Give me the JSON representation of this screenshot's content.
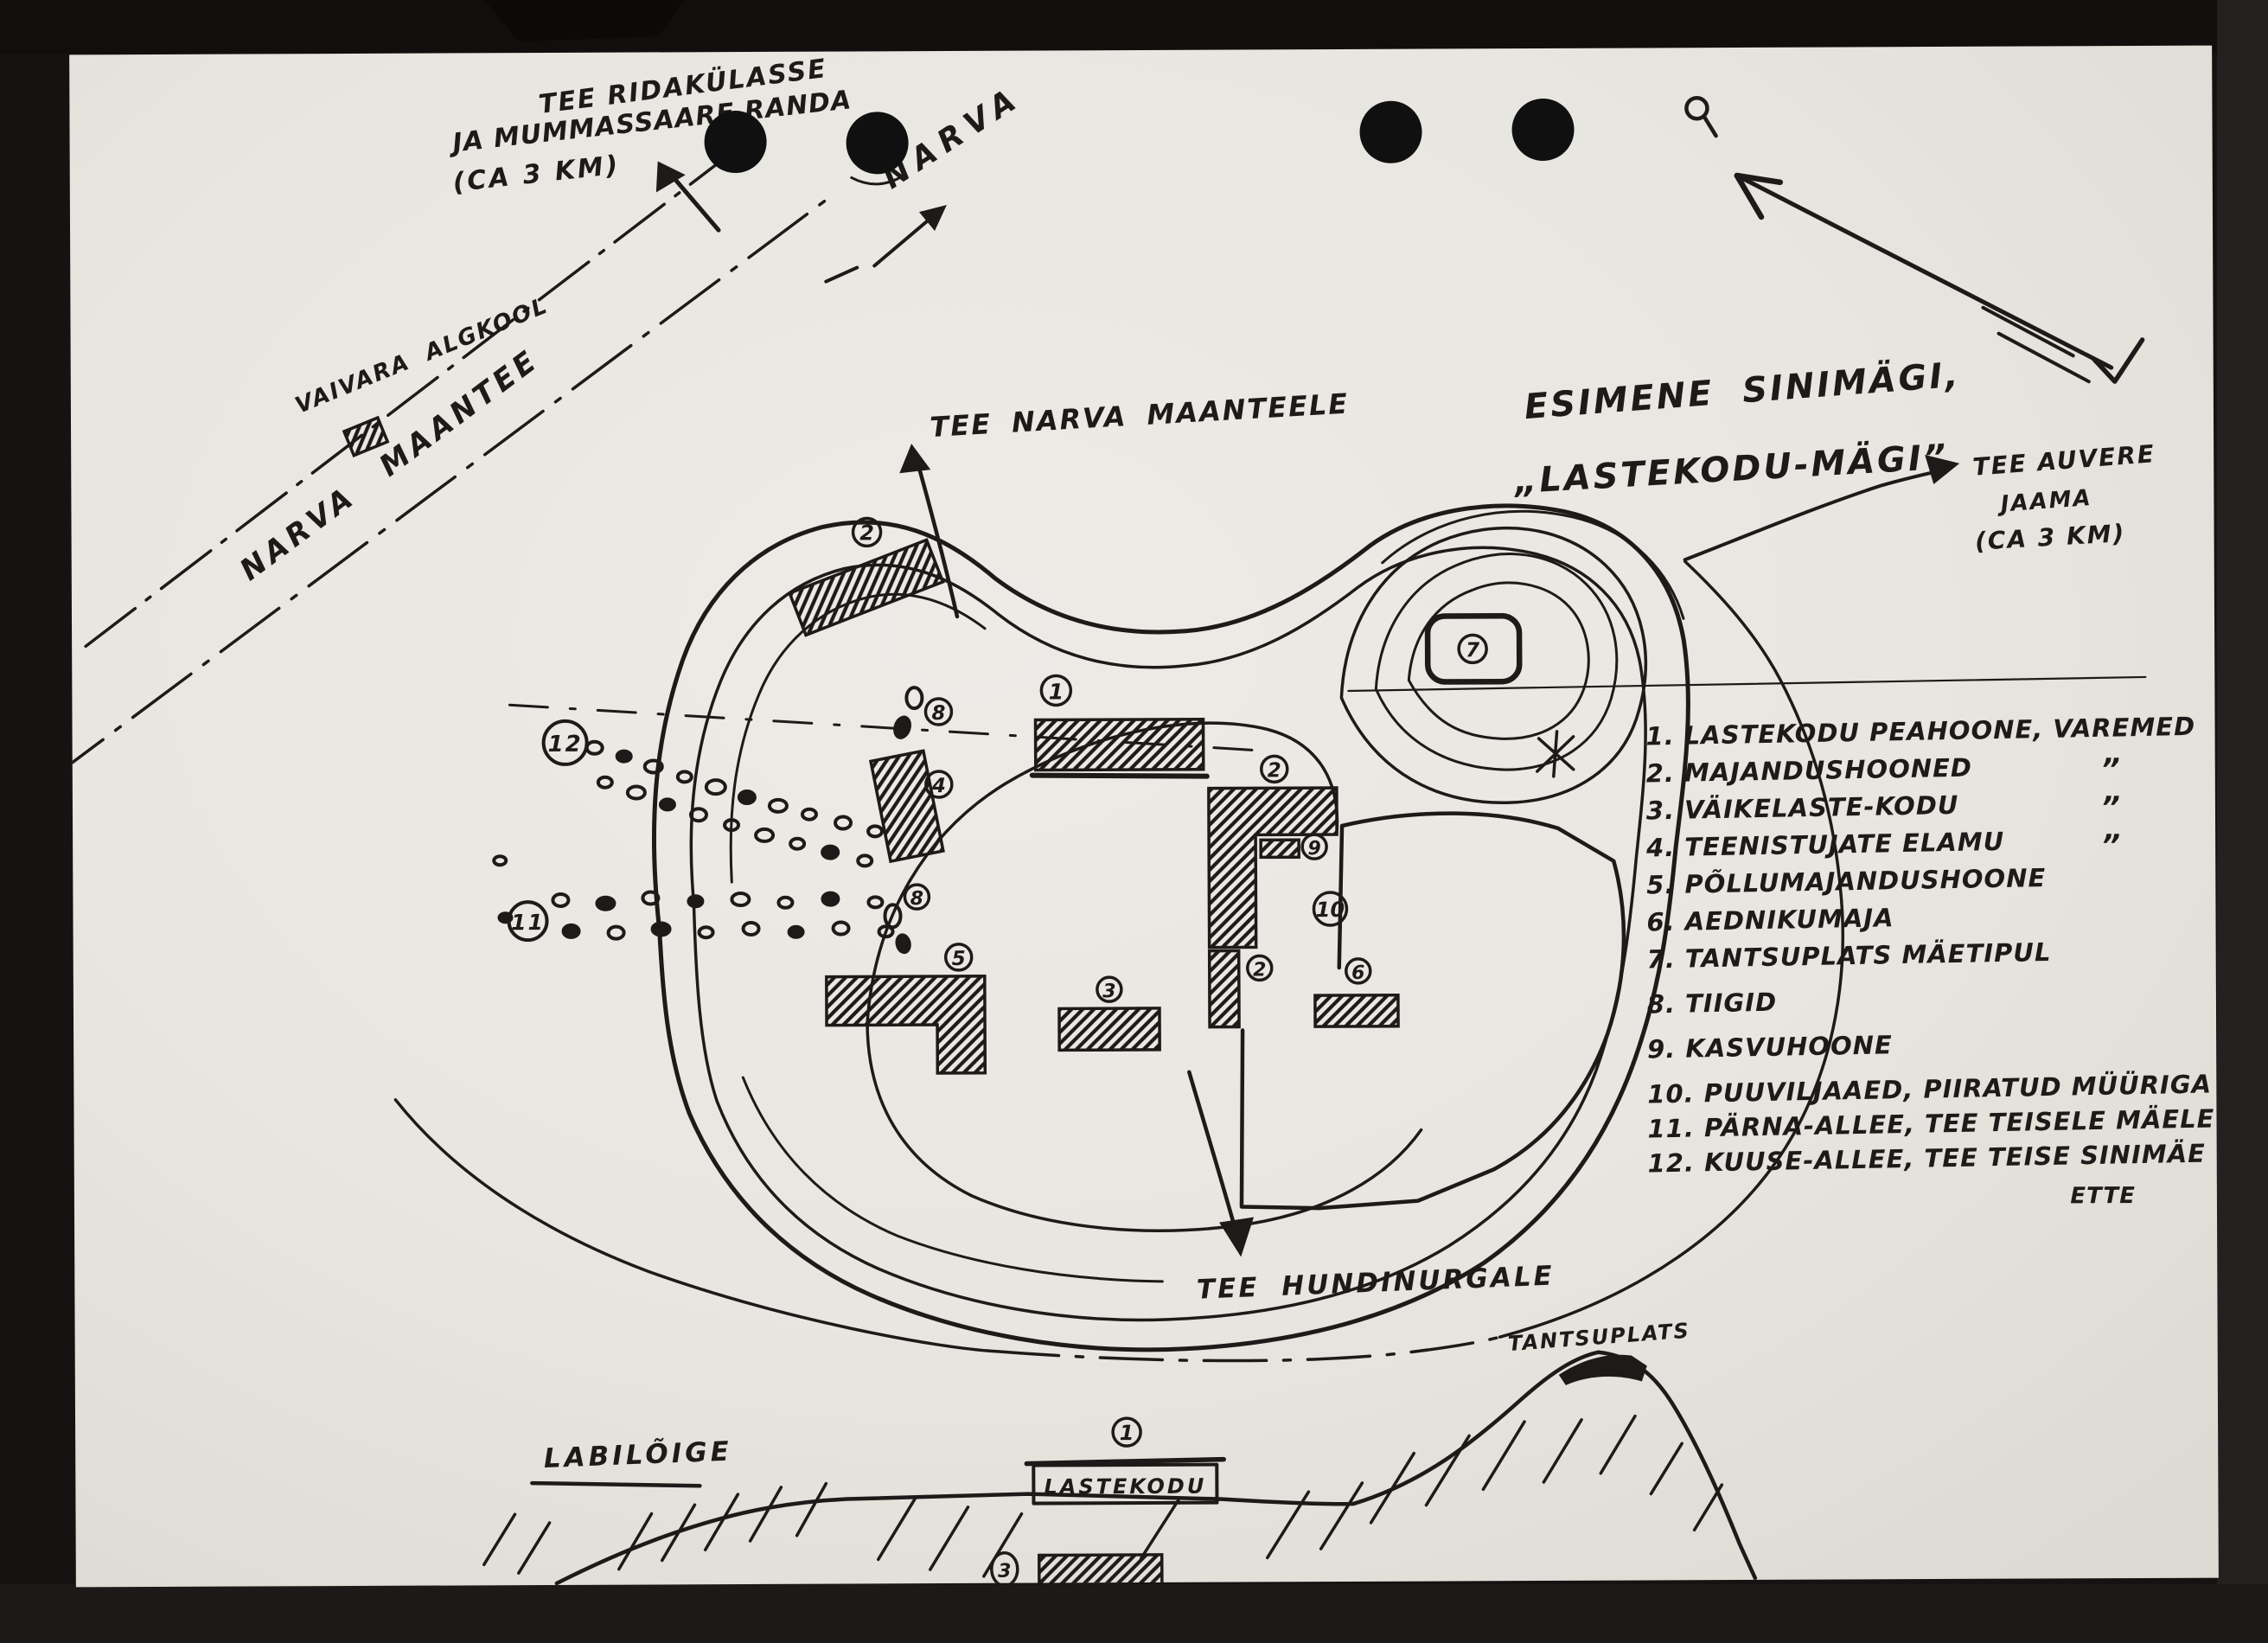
{
  "colors": {
    "background": "#151311",
    "paper": "#e9e7e1",
    "ink": "#1c1b19"
  },
  "annotations": {
    "top_left_road_note": {
      "line1": "TEE RIDAKÜLASSE",
      "line2": "JA MUMMASSAARE RANDA",
      "line3": "(CA 3 KM)"
    },
    "narva_direction": "NARVA",
    "vaivara_school": "VAIVARA ALGKOOL",
    "narva_road": "NARVA MAANTEE",
    "tee_narva_maanteele": "TEE NARVA MAANTEELE",
    "hill_title_line1": "ESIMENE SINIMÄGI,",
    "hill_title_line2": "„LASTEKODU-MÄGI”",
    "tee_auvere": {
      "line1": "TEE AUVERE",
      "line2": "JAAMA",
      "line3": "(CA 3 KM)"
    },
    "tee_hundinurgale": "TEE HUNDINURGALE"
  },
  "legend": {
    "items": [
      {
        "text": "1. LASTEKODU PEAHOONE, VAREMED"
      },
      {
        "text": "2. MAJANDUSHOONED"
      },
      {
        "text": "3. VÄIKELASTE-KODU"
      },
      {
        "text": "4. TEENISTUJATE ELAMU"
      },
      {
        "text": "5. PÕLLUMAJANDUSHOONE"
      },
      {
        "text": "6. AEDNIKUMAJA"
      },
      {
        "text": "7. TANTSUPLATS MÄETIPUL"
      },
      {
        "text": "8. TIIGID"
      },
      {
        "text": "9. KASVUHOONE"
      },
      {
        "text": "10. PUUVILJAAED, PIIRATUD MÜÜRIGA"
      },
      {
        "text": "11. PÄRNA-ALLEE, TEE TEISELE MÄELE"
      },
      {
        "text": "12. KUUSE-ALLEE, TEE TEISE SINIMÄE"
      }
    ],
    "continuation": "ETTE",
    "ditto_mark": "”"
  },
  "markers": {
    "building2_top": "2",
    "pond8_upper": "8",
    "building1": "1",
    "allee12": "12",
    "building4": "4",
    "building2_mid": "2",
    "building9": "9",
    "orchard10": "10",
    "allee11": "11",
    "pond8_lower": "8",
    "building5": "5",
    "building3": "3",
    "building2_low": "2",
    "building6": "6",
    "dance7": "7",
    "cross_section1": "1",
    "cross_section3": "3"
  },
  "cross_section": {
    "title": "LABILÕIGE",
    "building_label": "LASTEKODU",
    "peak_label": "TANTSUPLATS"
  }
}
